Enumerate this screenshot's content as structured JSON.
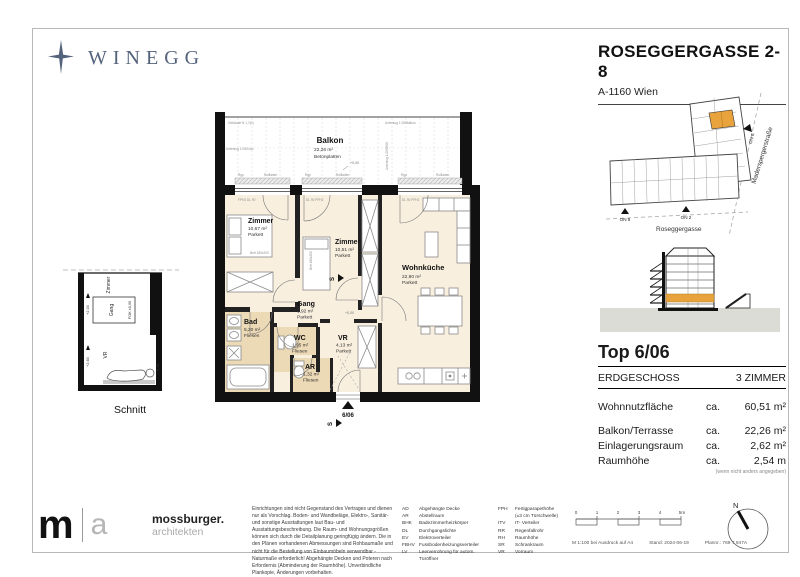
{
  "colors": {
    "accent_orange": "#E8A33C",
    "floor_cream": "#F8EFDF",
    "floor_tile": "#ECD9B6",
    "brand_slate": "#54637B",
    "ground_gray": "#DCDCD6"
  },
  "header": {
    "brand": "WINEGG",
    "title": "ROSEGGERGASSE 2-8",
    "subtitle": "A-1160 Wien"
  },
  "floorplan": {
    "balkon": {
      "name": "Balkon",
      "area": "22,26 m²",
      "floor": "Betonplatten"
    },
    "zimmer1": {
      "name": "Zimmer",
      "area": "10,67 m²",
      "floor": "Parkett"
    },
    "zimmer2": {
      "name": "Zimmer",
      "area": "10,51 m²",
      "floor": "Parkett"
    },
    "wohnkueche": {
      "name": "Wohnküche",
      "area": "22,90 m²",
      "floor": "Parkett"
    },
    "gang": {
      "name": "Gang",
      "area": "3,92 m²",
      "floor": "Parkett"
    },
    "bad": {
      "name": "Bad",
      "area": "5,20 m²",
      "floor": "Fliesen"
    },
    "wc": {
      "name": "WC",
      "area": "1,95 m²",
      "floor": "Fliesen"
    },
    "ar": {
      "name": "AR",
      "area": "1,32 m²",
      "floor": "Fliesen"
    },
    "vr": {
      "name": "VR",
      "area": "4,13 m²",
      "floor": "Parkett"
    },
    "unit_marker": "6/06",
    "section_letter": "S",
    "annotations": {
      "rgp": "Rgp",
      "rollladen": "Rollladen",
      "win1_label": "FPH2 DL 90",
      "win2_label": "DL 90  FPH2",
      "win3_label": "DL 90  FPH2",
      "level_zero": "+0,00",
      "bed1": "Bett 180x200",
      "beam_tl": "Gebäude N 1,7(h)",
      "beam_tr": "Unterzug 1.05/Balkon",
      "beam_l": "Unterzug 1.05/0,kw",
      "beam_r": "Unterzug 1.05/OKfb"
    }
  },
  "schnitt": {
    "title": "Schnitt",
    "room_top": "Zimmer",
    "room_mid": "Gang",
    "room_bottom": "VR",
    "fok": "FOK ±0,00",
    "level_a": "+2,04",
    "level_b": "+2,64",
    "level_c": "-0,16"
  },
  "siteplan": {
    "street_right": "Maderspergerstraße",
    "street_bottom": "Roseggergasse",
    "entrance_1": "ON 8",
    "entrance_2": "ON 2",
    "entrance_3": "ON 6"
  },
  "unit": {
    "title": "Top 6/06",
    "floor_label": "ERDGESCHOSS",
    "rooms_label": "3 ZIMMER",
    "rows": [
      {
        "label": "Wohnnutzfläche",
        "ca": "ca.",
        "value": "60,51 m²"
      },
      {
        "label": "Balkon/Terrasse",
        "ca": "ca.",
        "value": "22,26 m²"
      },
      {
        "label": "Einlagerungsraum",
        "ca": "ca.",
        "value": "2,62 m²"
      },
      {
        "label": "Raumhöhe",
        "ca": "ca.",
        "value": "2,54 m"
      }
    ],
    "note": "(wenn nicht anders angegeben)"
  },
  "footer": {
    "logo_m": "m",
    "logo_a": "a",
    "architect_name": "mossburger.",
    "architect_sub": "architekten",
    "disclaimer": "Einrichtungen sind nicht Gegenstand des Vertrages und dienen nur als Vorschlag. Boden- und Wandbeläge, Elektro-, Sanitär- und sonstige Ausstattungen laut Bau- und Ausstattungsbeschreibung. Die Raum- und Wohnungsgrößen können sich durch die Detailplanung geringfügig ändern. Die in den Plänen vorhandenen Abmessungen sind Rohbaumaße und nicht für die Bestellung von Einbaumöbeln verwendbar - Naturmaße erforderlich! Abgehängte Decken und Poteren nach Erfordernis (Abminderung der Raumhöhe). Unverbindliche Plankopie, Änderungen vorbehalten.",
    "legend_col1": [
      {
        "abbr": "AD",
        "text": "Abgehängte Decke"
      },
      {
        "abbr": "AR",
        "text": "Abstellraum"
      },
      {
        "abbr": "BHK",
        "text": "Badezimmerheizkörper"
      },
      {
        "abbr": "DL",
        "text": "Durchgangslichte"
      },
      {
        "abbr": "EV",
        "text": "Elektroverteiler"
      },
      {
        "abbr": "FBHV",
        "text": "Fussbodenheizungsverteiler"
      },
      {
        "abbr": "LV",
        "text": "Leerverrohrung für autom. Türöffner"
      }
    ],
    "legend_col2": [
      {
        "abbr": "FPH",
        "text": "Fertigparapethöhe"
      },
      {
        "abbr": "",
        "text": "(±3 cm Türschwelle)"
      },
      {
        "abbr": "ITV",
        "text": "IT- Verteiler"
      },
      {
        "abbr": "RR",
        "text": "Regenfallrohr"
      },
      {
        "abbr": "RH",
        "text": "Raumhöhe"
      },
      {
        "abbr": "SR",
        "text": "Schrankraum"
      },
      {
        "abbr": "VR",
        "text": "Vorraum"
      }
    ],
    "scale_ticks": [
      "0",
      "1",
      "2",
      "3",
      "4",
      "5m"
    ],
    "print_scale": "M 1:100 bei Ausdruck auf A4",
    "print_date": "Stand: 2024-06-19",
    "print_plan": "Plannr.: 769 T 947A",
    "north_label": "N"
  }
}
